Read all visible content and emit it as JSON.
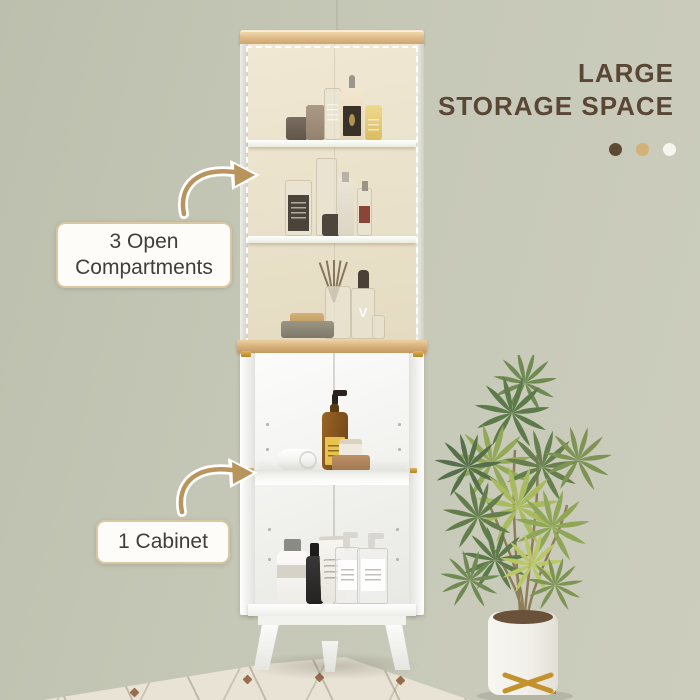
{
  "headline": {
    "line1": "LARGE",
    "line2": "STORAGE SPACE",
    "color": "#594634",
    "dots": [
      {
        "name": "dot-brown",
        "color": "#5d4a35"
      },
      {
        "name": "dot-tan",
        "color": "#d3b278"
      },
      {
        "name": "dot-white",
        "color": "#f7f5ee"
      }
    ]
  },
  "callouts": {
    "open_compartments": "3 Open Compartments",
    "cabinet": "1 Cabinet"
  },
  "decor": {
    "diffuser_letter": "V"
  },
  "scene": {
    "product": "white corner storage cabinet with oak top",
    "open_shelf_items": [
      "dark box",
      "taupe box",
      "clear bottle",
      "cream pump bottle",
      "yellow box",
      "labeled glass bottle",
      "tall clear bottle",
      "white spray bottle",
      "reed diffuser",
      "dropper bottle",
      "soap tray"
    ],
    "cabinet_items": [
      "amber soap dispenser",
      "rolled towel",
      "cream jar on cork tray",
      "white bottle",
      "black spray bottle",
      "white tube",
      "two clear pump bottles"
    ],
    "side_decor": "potted palm plant in white planter with gold stand"
  },
  "palette": {
    "wall": "#c6c8b7",
    "floor": "#e8e3d5",
    "wood": "#d9b684",
    "cabinet_white": "#fafaf8",
    "gold_accent": "#c79a3a",
    "arrow": "#b9955e"
  }
}
